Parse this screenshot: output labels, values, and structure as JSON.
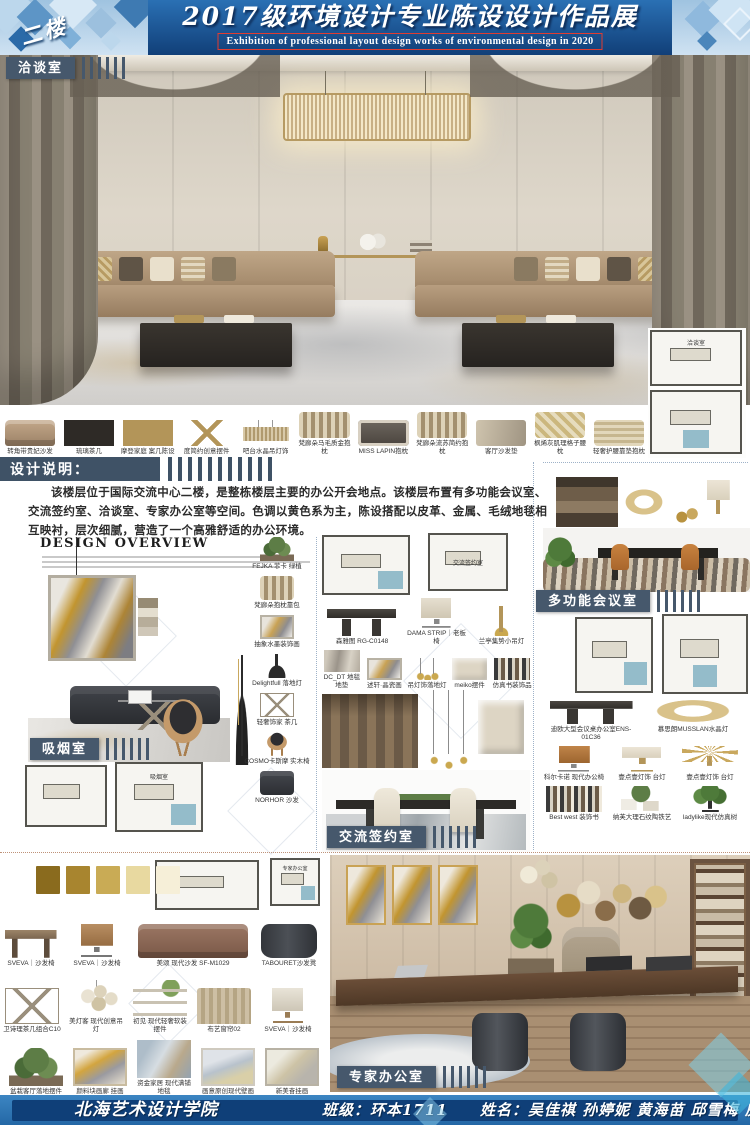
{
  "header": {
    "floor_badge": "二楼",
    "title": "2017级环境设计专业陈设设计作品展",
    "subtitle": "Exhibition of professional layout design works of environmental design in 2020"
  },
  "labels": {
    "negotiation_room": "洽谈室",
    "smoking_room": "吸烟室",
    "meeting_room": "多功能会议室",
    "signing_room": "交流签约室",
    "expert_office": "专家办公室",
    "design_notes_heading": "设计说明："
  },
  "plan_labels": {
    "negotiation": "洽谈室",
    "smoking": "吸烟室",
    "signing": "交流签约室",
    "expert": "专家办公室"
  },
  "design_notes": {
    "body": "该楼层位于国际交流中心二楼，是整栋楼层主要的办公开会地点。该楼层布置有多功能会议室、交流签约室、洽谈室、专家办公室等空间。色调以黄色系为主，陈设搭配以皮革、金属、毛绒地毯相互映衬，层次细腻，营造了一个高雅舒适的办公环境。"
  },
  "overview": {
    "title": "DESIGN OVERVIEW"
  },
  "hero_products": {
    "items": [
      {
        "label": "转角带贵妃沙发",
        "icon": "sofa-corner"
      },
      {
        "label": "琉璃茶几",
        "icon": "coffee-table"
      },
      {
        "label": "摩登家庭 案几陈设",
        "icon": "console"
      },
      {
        "label": "度简约创意摆件",
        "icon": "stand"
      },
      {
        "label": "吧台水晶吊灯饰",
        "icon": "bar-chandelier"
      },
      {
        "label": "梵廊朵马毛质金抱枕",
        "icon": "pillow"
      },
      {
        "label": "MISS LAPIN抱枕",
        "icon": "pillow-dark"
      },
      {
        "label": "梵廊朵流苏简约抱枕",
        "icon": "pillow"
      },
      {
        "label": "客厅沙发垫",
        "icon": "cushion"
      },
      {
        "label": "枫烯灰肌理格子腰枕",
        "icon": "pillow-gold"
      },
      {
        "label": "轻奢护腰靠垫抱枕",
        "icon": "pillow-tassel"
      }
    ]
  },
  "smoking_products": {
    "items": [
      {
        "label": "FEJKA 菲卡 绿植",
        "icon": "plant"
      },
      {
        "label": "梵廊朵抱枕靠包",
        "icon": "pillow"
      },
      {
        "label": "抽象水墨装饰画",
        "icon": "art"
      },
      {
        "label": "Delightfull 落地灯",
        "icon": "floor-lamp"
      },
      {
        "label": "轻奢饰家 茶几",
        "icon": "wire-table"
      },
      {
        "label": "COSMO卡斯摩 实木椅",
        "icon": "chair"
      },
      {
        "label": "NORHOR 沙发",
        "icon": "sofa-dark"
      }
    ]
  },
  "mid_products": {
    "items": [
      {
        "label": "森雅图 RG-C0148",
        "icon": "conference-table"
      },
      {
        "label": "DAMA STRIP｜老板椅",
        "icon": "exec-chair"
      },
      {
        "label": "兰亭集势小吊灯",
        "icon": "rod-lamp"
      }
    ]
  },
  "mid_caption_products": {
    "items": [
      {
        "label": "DC_DT 地毯地垫",
        "icon": "rug"
      },
      {
        "label": "述轩·晶瓷画",
        "icon": "art"
      },
      {
        "label": "吊灯饰落地灯",
        "icon": "pendants"
      },
      {
        "label": "meiko摆件",
        "icon": "relief"
      },
      {
        "label": "仿真书装饰品",
        "icon": "books"
      }
    ]
  },
  "meeting_products": {
    "items": [
      {
        "label": "迪欧大型会议桌办公室ENS-01C36",
        "icon": "conference-table",
        "wide": true
      },
      {
        "label": "慕思朗MUSSLAN水晶灯",
        "icon": "ring-chandelier",
        "wide": true
      },
      {
        "label": "科尔卡诺 现代办公椅",
        "icon": "chair-tan"
      },
      {
        "label": "壹点壹灯饰 台灯",
        "icon": "table-lamp"
      },
      {
        "label": "壹点壹灯饰 台灯",
        "icon": "palm-lamp"
      },
      {
        "label": "Best west 装饰书",
        "icon": "books"
      },
      {
        "label": "纳芙大理石纹陶铁艺",
        "icon": "plant-frames"
      },
      {
        "label": "ladylike现代仿真树",
        "icon": "tree"
      }
    ]
  },
  "bottom_rows": {
    "row1": [
      {
        "label": "SVEVA｜沙发椅",
        "icon": "desk"
      },
      {
        "label": "SVEVA｜沙发椅",
        "icon": "swivel-chair"
      },
      {
        "label": "美颂 现代沙发 SF-M1029",
        "icon": "sofa-brown",
        "wide": true
      },
      {
        "label": "TABOURET沙发凳",
        "icon": "stool"
      }
    ],
    "row2": [
      {
        "label": "卫诗理茶几组合C10",
        "icon": "wire-table"
      },
      {
        "label": "美灯客 现代创意吊灯",
        "icon": "glass-chandelier"
      },
      {
        "label": "初见 现代轻奢软装摆件",
        "icon": "shelf-decor"
      },
      {
        "label": "布艺窗帘02",
        "icon": "curtain"
      },
      {
        "label": "SVEVA｜沙发椅",
        "icon": "chair-white"
      }
    ],
    "row3": [
      {
        "label": "盆栽客厅落地摆件",
        "icon": "plant"
      },
      {
        "label": "颜料块画廊 挂画",
        "icon": "art-gold"
      },
      {
        "label": "资金家居 现代满铺地毯",
        "icon": "rug-blue"
      },
      {
        "label": "画意原创现代壁画",
        "icon": "art-abstract"
      },
      {
        "label": "新美奋挂画",
        "icon": "art-frame"
      }
    ]
  },
  "palette": {
    "swatches": [
      {
        "color": "#8a6b1e"
      },
      {
        "color": "#a8852f"
      },
      {
        "color": "#c9ab55"
      },
      {
        "color": "#e8d9a0"
      },
      {
        "color": "#f6efd8"
      }
    ]
  },
  "footer": {
    "school": "北海艺术设计学院",
    "class_label": "班级：环本1711",
    "names_label": "姓名：吴佳祺 孙婷妮 黄海苗 邱雪梅 房钊龙"
  },
  "colors": {
    "header_blue": "#1d5d9f",
    "label_slate": "#46586c",
    "footer_navy": "#0f3f78",
    "accent_gold": "#b39559"
  }
}
